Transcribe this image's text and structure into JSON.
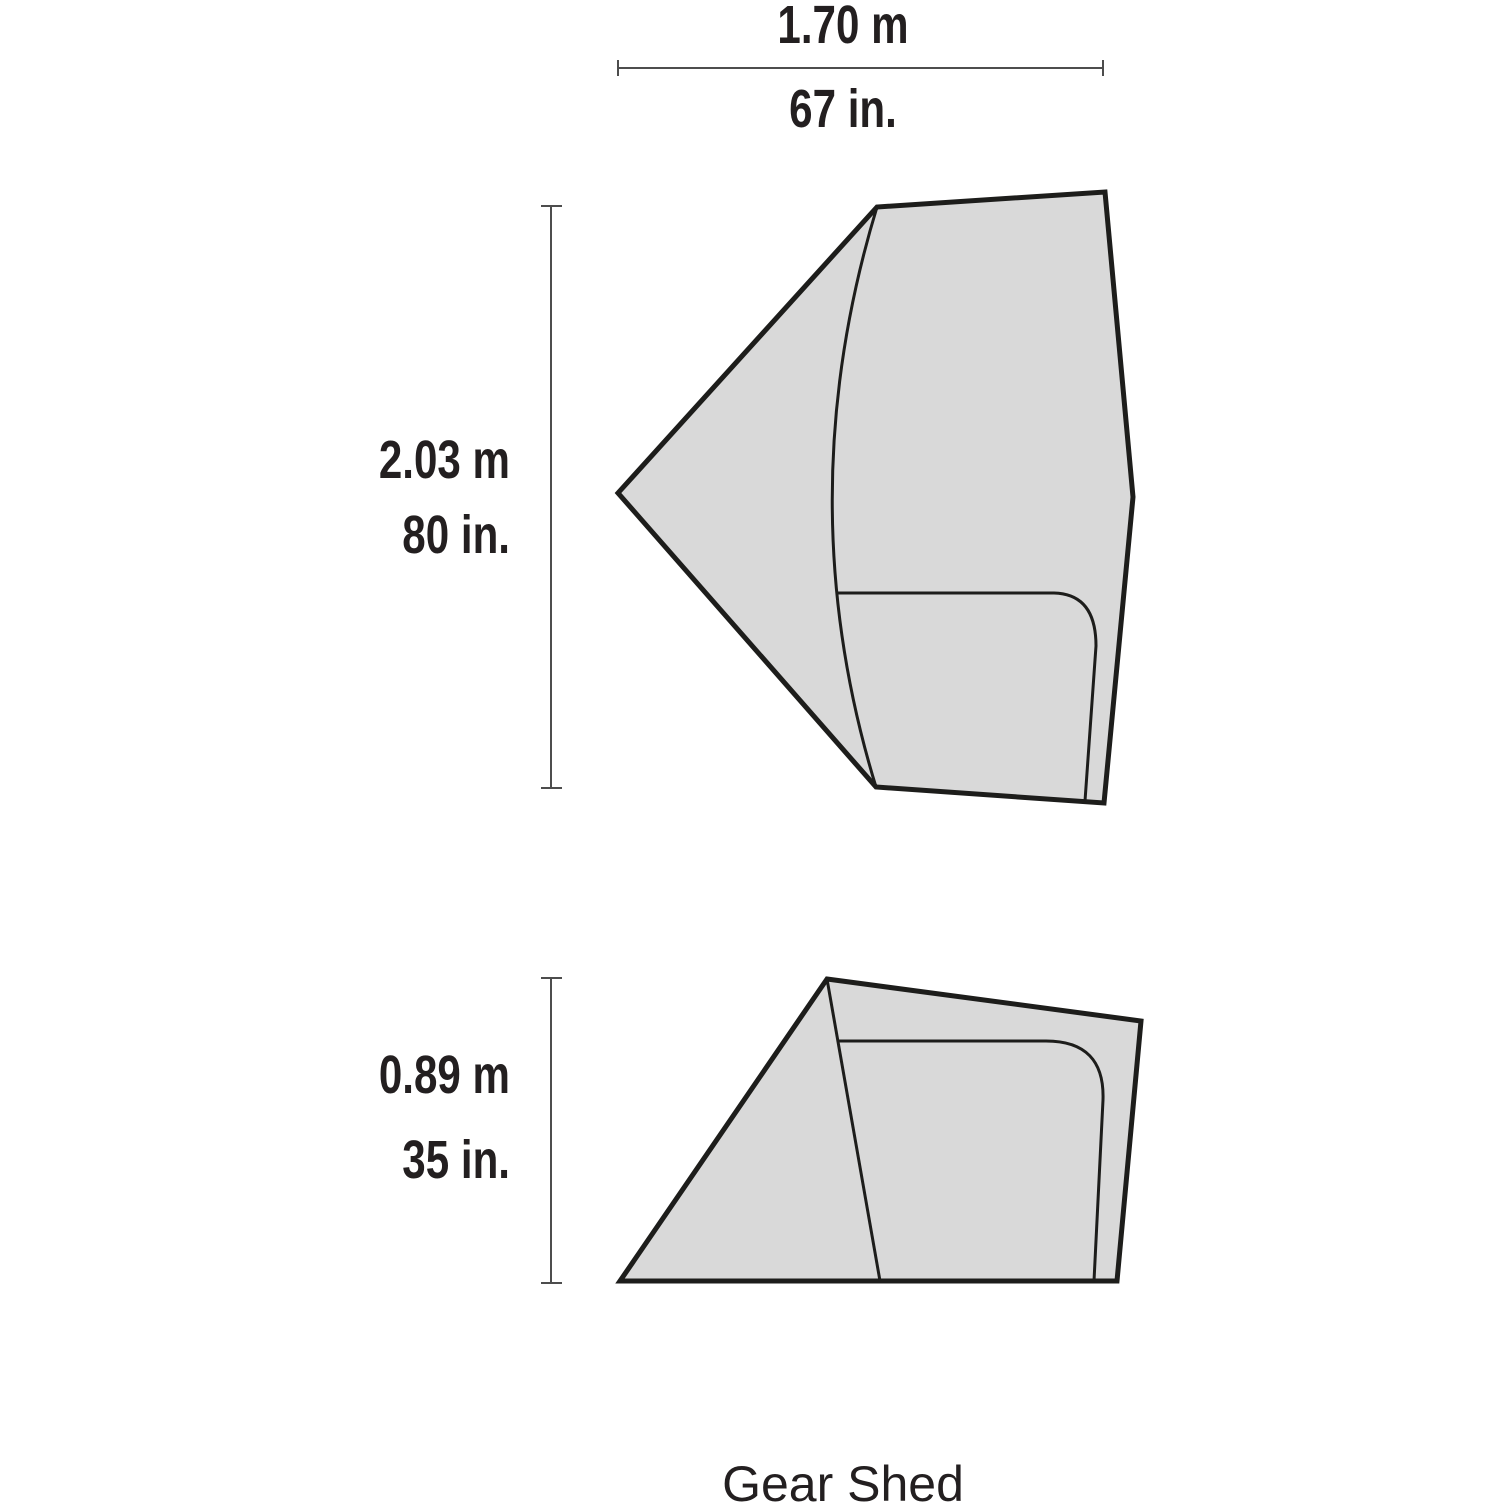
{
  "title": "Gear Shed",
  "dimensions": {
    "width": {
      "metric": "1.70 m",
      "imperial": "67 in."
    },
    "depth": {
      "metric": "2.03 m",
      "imperial": "80 in."
    },
    "height": {
      "metric": "0.89 m",
      "imperial": "35 in."
    }
  },
  "colors": {
    "background": "#ffffff",
    "shape_fill": "#d9d9d9",
    "shape_outline": "#1d1d1b",
    "inner_line": "#1d1d1b",
    "dimension_line": "#4d4d4d",
    "text": "#231f20"
  }
}
